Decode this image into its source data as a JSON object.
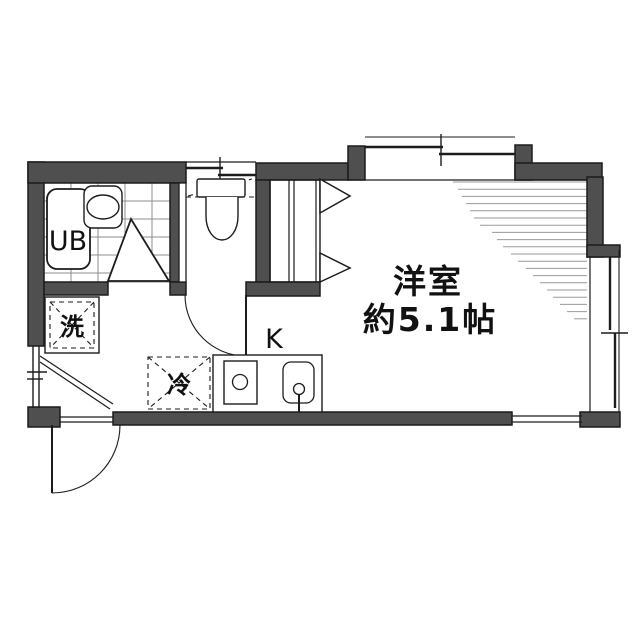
{
  "labels": {
    "room_name": "洋室",
    "room_area": "約5.1帖",
    "unit_bath": "UB",
    "kitchen": "K",
    "washer": "洗",
    "fridge": "冷"
  },
  "colors": {
    "wall": "#4f4f4f",
    "line": "#1c1c1c",
    "hatch": "#9a9a9a",
    "tile": "#8c8c8c",
    "background": "#ffffff"
  },
  "hatch": {
    "x_right": 587,
    "y_start": 182,
    "y_step": 7.2,
    "left_ends": [
      453,
      458,
      462,
      466,
      470,
      474,
      480,
      492,
      497,
      503,
      511,
      518,
      526,
      533,
      540,
      547,
      553,
      560,
      567,
      574
    ]
  },
  "tile": {
    "x0": 44,
    "x1": 172,
    "y0": 183,
    "y1": 282,
    "v_lines": [
      71,
      98,
      125,
      152
    ],
    "h_lines": [
      201,
      219,
      237,
      255,
      273
    ]
  }
}
